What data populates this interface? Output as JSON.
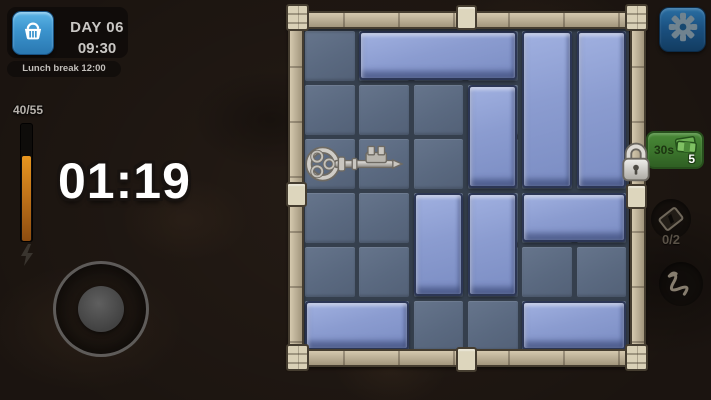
{
  "hud": {
    "day": "DAY 06",
    "clock": "09:30",
    "event": "Lunch break 12:00",
    "energy_count": "40/55",
    "energy_fill_pct": 73,
    "timer": "01:19"
  },
  "right_panel": {
    "reward_time": "30s",
    "reward_amount": "5",
    "card_count": "0/2"
  },
  "board": {
    "rows": 6,
    "cols": 6,
    "exit_row": 3,
    "key": {
      "row": 3,
      "col": 1,
      "w": 2,
      "h": 1
    },
    "blocks": [
      {
        "row": 1,
        "col": 2,
        "w": 3,
        "h": 1
      },
      {
        "row": 1,
        "col": 5,
        "w": 1,
        "h": 3
      },
      {
        "row": 1,
        "col": 6,
        "w": 1,
        "h": 3
      },
      {
        "row": 2,
        "col": 4,
        "w": 1,
        "h": 2
      },
      {
        "row": 4,
        "col": 3,
        "w": 1,
        "h": 2
      },
      {
        "row": 4,
        "col": 4,
        "w": 1,
        "h": 2
      },
      {
        "row": 4,
        "col": 5,
        "w": 2,
        "h": 1
      },
      {
        "row": 6,
        "col": 1,
        "w": 2,
        "h": 1
      },
      {
        "row": 6,
        "col": 5,
        "w": 2,
        "h": 1
      }
    ]
  },
  "colors": {
    "block": "#8b9cd0",
    "cell": "#5a6980",
    "frame": "#b8ac92",
    "accent_blue": "#3b93cd",
    "gauge_orange": "#c1741a",
    "badge_green": "#3b742c"
  }
}
